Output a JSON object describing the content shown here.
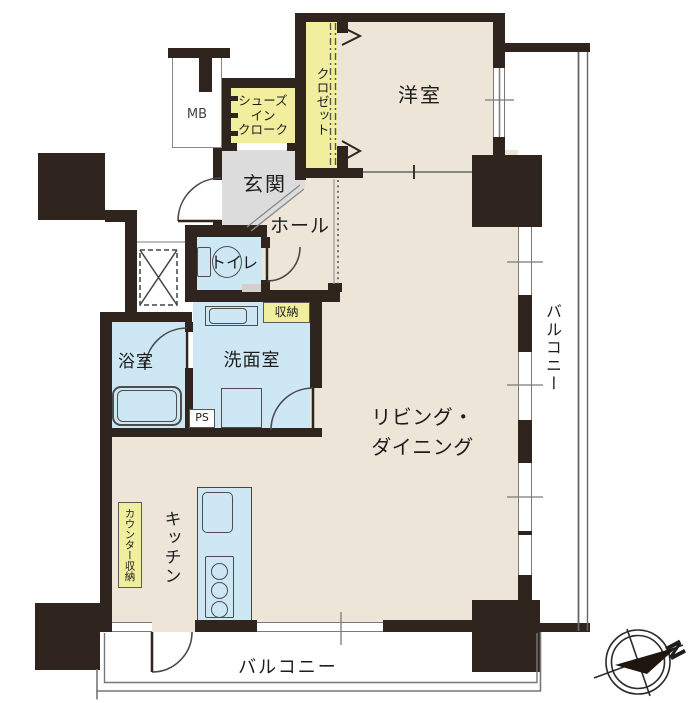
{
  "plan_type": "apartment-floor-plan",
  "rooms": {
    "western_room": {
      "label": "洋室"
    },
    "closet": {
      "label": "クロゼット"
    },
    "shoes_in_cloak": {
      "label": "シューズ\nイン\nクローク"
    },
    "meter_box": {
      "label": "MB"
    },
    "entrance": {
      "label": "玄関"
    },
    "hall": {
      "label": "ホール"
    },
    "toilet": {
      "label": "トイレ"
    },
    "storage": {
      "label": "収納"
    },
    "bathroom": {
      "label": "浴室"
    },
    "washroom": {
      "label": "洗面室"
    },
    "living_dining": {
      "label": "リビング・\nダイニング"
    },
    "kitchen": {
      "label": "キッチン"
    },
    "counter_storage": {
      "label": "カウンター収納"
    },
    "pipe_space": {
      "label": "PS"
    },
    "balcony_right": {
      "label": "バルコニー"
    },
    "balcony_bottom": {
      "label": "バルコニー"
    }
  },
  "compass": {
    "north_label": "N"
  },
  "colors": {
    "wall": "#2f241e",
    "floor_cream": "#ece5d8",
    "wet_area_blue": "#cde7f4",
    "storage_yellow": "#f1ef9e",
    "entrance_gray": "#dcdcdc",
    "thin_line": "#7a7a7a"
  }
}
